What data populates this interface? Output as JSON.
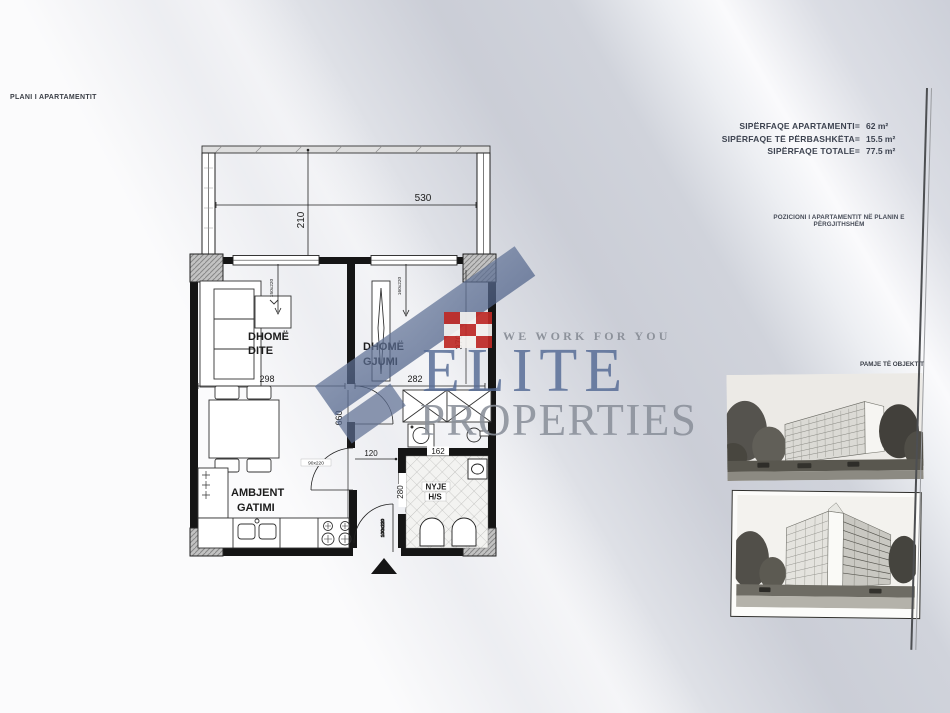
{
  "page": {
    "title": "PLANI I APARTAMENTIT"
  },
  "areas": {
    "rows": [
      {
        "label": "SIPËRFAQE APARTAMENTI=",
        "value": "62 m²"
      },
      {
        "label": "SIPËRFAQE TË PËRBASHKËTA=",
        "value": "15.5 m²"
      },
      {
        "label": "SIPËRFAQE TOTALE=",
        "value": "77.5 m²"
      }
    ]
  },
  "position_note": "POZICIONI I APARTAMENTIT NË PLANIN E PËRGJITHSHËM",
  "photos": {
    "caption": "PAMJE TË OBJEKTIT"
  },
  "watermark": {
    "tagline": "WE WORK FOR YOU",
    "brand": "ELITE",
    "brand2": "PROPERTIES",
    "brand_blue": "#536994",
    "accent_red": "#bf2a26"
  },
  "plan": {
    "rooms": {
      "living": {
        "l1": "DHOMË",
        "l2": "DITE"
      },
      "bedroom": {
        "l1": "DHOMË",
        "l2": "GJUMI"
      },
      "kitchen": {
        "l1": "AMBJENT",
        "l2": "GATIMI"
      },
      "bath": {
        "l1": "NYJE",
        "l2": "H/S"
      }
    },
    "dims": {
      "balcony_w": "530",
      "balcony_d": "210",
      "living_w": "298",
      "living_h": "660",
      "bedroom_w": "282",
      "bedroom_h": "370",
      "hall_w": "120",
      "bath_w": "162",
      "bath_h": "280",
      "door_kitchen": "90x220",
      "door_bath": "60x220",
      "door_entry": "100x220",
      "window_living": "150x220",
      "window_bedroom": "160x220"
    }
  }
}
